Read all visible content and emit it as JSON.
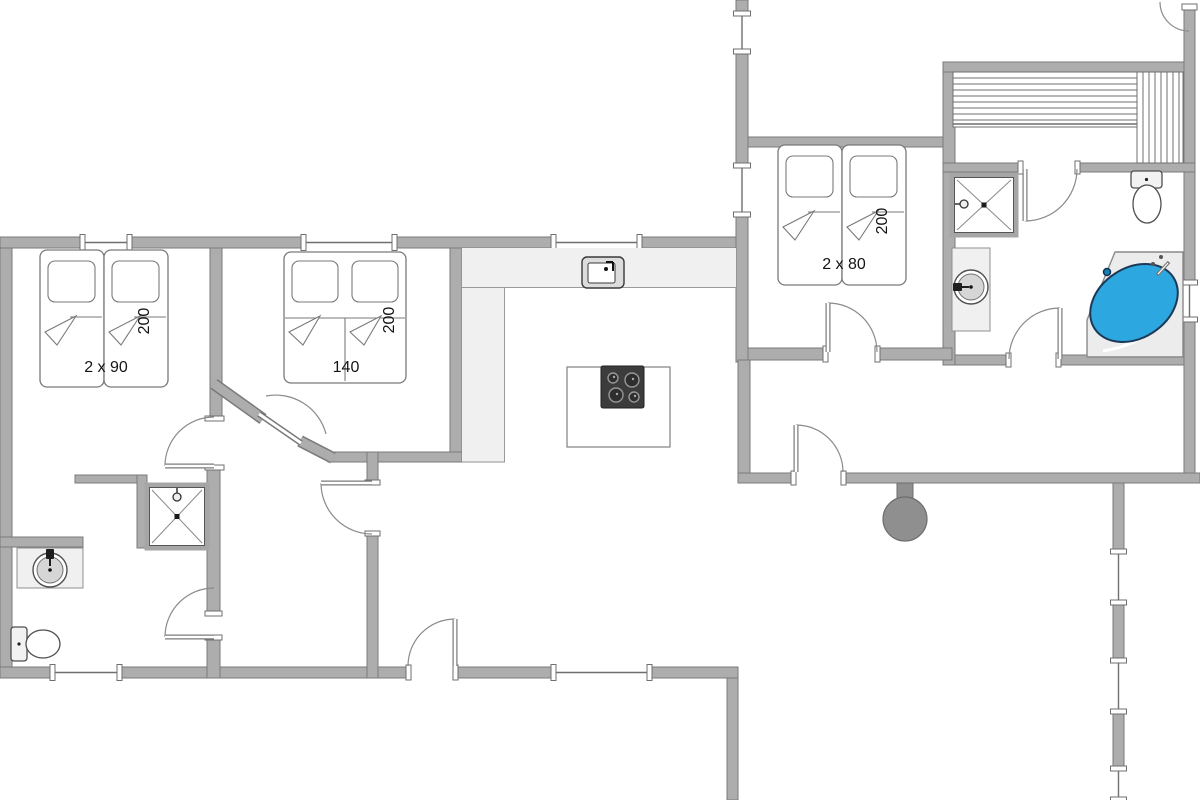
{
  "plan": {
    "width": 1200,
    "height": 800,
    "colors": {
      "wall_fill": "#adadad",
      "wall_edge": "#7a7a7a",
      "line": "#8a8a8a",
      "thin_line": "#6f6f6f",
      "floor": "#ffffff",
      "counter_fill": "#f0f0f0",
      "fixture_light": "#f0f0f0",
      "sink_inner": "#d6d6d6",
      "stove_dark": "#3c3c3c",
      "burner_rim": "#979797",
      "tub_blue": "#2da7e0",
      "tub_edge": "#1c3a57",
      "tub_base": "#ececec",
      "wood_stove": "#8f8f8f",
      "label": "#141414"
    },
    "labels": [
      {
        "text": "2 x 90",
        "x": 106,
        "y": 372,
        "rot": 0
      },
      {
        "text": "200",
        "x": 149,
        "y": 321,
        "rot": -90
      },
      {
        "text": "140",
        "x": 346,
        "y": 372,
        "rot": 0
      },
      {
        "text": "200",
        "x": 394,
        "y": 320,
        "rot": -90
      },
      {
        "text": "2 x 80",
        "x": 844,
        "y": 269,
        "rot": 0
      },
      {
        "text": "200",
        "x": 887,
        "y": 221,
        "rot": -90
      }
    ],
    "walls": [
      [
        0,
        237,
        12,
        441
      ],
      [
        0,
        237,
        746,
        11
      ],
      [
        736,
        0,
        12,
        362
      ],
      [
        748,
        137,
        205,
        10
      ],
      [
        943,
        62,
        12,
        303
      ],
      [
        943,
        62,
        252,
        10
      ],
      [
        1184,
        8,
        11,
        467
      ],
      [
        943,
        163,
        252,
        9
      ],
      [
        955,
        355,
        229,
        10
      ],
      [
        748,
        348,
        204,
        12
      ],
      [
        738,
        360,
        12,
        123
      ],
      [
        738,
        473,
        462,
        10
      ],
      [
        1113,
        483,
        11,
        317
      ],
      [
        727,
        667,
        11,
        133
      ],
      [
        0,
        667,
        738,
        11
      ],
      [
        210,
        248,
        12,
        170
      ],
      [
        450,
        248,
        12,
        214
      ],
      [
        75,
        475,
        72,
        8
      ],
      [
        137,
        475,
        10,
        73
      ],
      [
        207,
        468,
        13,
        145
      ],
      [
        207,
        638,
        13,
        40
      ],
      [
        0,
        537,
        83,
        10
      ],
      [
        328,
        452,
        134,
        10
      ],
      [
        367,
        452,
        11,
        226
      ]
    ],
    "diag_walls": [
      [
        214,
        384,
        263,
        419
      ],
      [
        300,
        441,
        333,
        458
      ]
    ],
    "caps_extra": [
      [
        1182,
        4,
        15,
        6
      ]
    ],
    "openings": [
      {
        "x": 207,
        "y": 418,
        "w": 15,
        "h": 50,
        "dir": "v"
      },
      {
        "x": 367,
        "y": 482,
        "w": 11,
        "h": 52,
        "dir": "v"
      },
      {
        "x": 207,
        "y": 613,
        "w": 13,
        "h": 25,
        "dir": "v"
      },
      {
        "x": 408,
        "y": 667,
        "w": 48,
        "h": 11,
        "dir": "h"
      },
      {
        "x": 793,
        "y": 473,
        "w": 51,
        "h": 10,
        "dir": "h"
      },
      {
        "x": 825,
        "y": 348,
        "w": 53,
        "h": 12,
        "dir": "h"
      },
      {
        "x": 1020,
        "y": 163,
        "w": 58,
        "h": 9,
        "dir": "h"
      },
      {
        "x": 1008,
        "y": 355,
        "w": 51,
        "h": 10,
        "dir": "h"
      }
    ],
    "windows": [
      {
        "dir": "h",
        "x": 82,
        "y": 237,
        "len": 48,
        "t": 11
      },
      {
        "dir": "h",
        "x": 303,
        "y": 237,
        "len": 92,
        "t": 11
      },
      {
        "dir": "h",
        "x": 553,
        "y": 237,
        "len": 87,
        "t": 11
      },
      {
        "dir": "h",
        "x": 52,
        "y": 667,
        "len": 68,
        "t": 11
      },
      {
        "dir": "h",
        "x": 553,
        "y": 667,
        "len": 97,
        "t": 11
      },
      {
        "dir": "v",
        "x": 736,
        "y": 13,
        "len": 39,
        "t": 12
      },
      {
        "dir": "v",
        "x": 736,
        "y": 165,
        "len": 50,
        "t": 12
      },
      {
        "dir": "v",
        "x": 1184,
        "y": 282,
        "len": 38,
        "t": 11
      },
      {
        "dir": "v",
        "x": 1113,
        "y": 551,
        "len": 52,
        "t": 11
      },
      {
        "dir": "v",
        "x": 1113,
        "y": 660,
        "len": 52,
        "t": 11
      },
      {
        "dir": "v",
        "x": 1113,
        "y": 768,
        "len": 32,
        "t": 11
      }
    ],
    "doors": [
      {
        "hx": 214,
        "hy": 466,
        "r": 49,
        "a0": 180,
        "leaf": 180
      },
      {
        "hx": 372,
        "hy": 483,
        "r": 51,
        "a0": 90,
        "leaf": 180
      },
      {
        "hx": 214,
        "hy": 637,
        "r": 49,
        "a0": 180,
        "leaf": 180
      },
      {
        "hx": 455,
        "hy": 666,
        "r": 47,
        "a0": 180,
        "leaf": 270
      },
      {
        "hx": 796,
        "hy": 472,
        "r": 47,
        "a0": 270,
        "leaf": 270
      },
      {
        "hx": 828,
        "hy": 352,
        "r": 49,
        "a0": 270,
        "leaf": 270
      },
      {
        "hx": 1025,
        "hy": 169,
        "r": 52,
        "a0": 0,
        "leaf": 90
      },
      {
        "hx": 1060,
        "hy": 359,
        "r": 51,
        "a0": 180,
        "leaf": 270
      },
      {
        "hx": 1189,
        "hy": 2,
        "r": 29,
        "a0": 90,
        "leaf": null
      }
    ],
    "angled_door": {
      "arc": "M 266 396 A 52 52 0 0 1 326 434",
      "leaf": [
        259,
        414,
        301,
        443
      ]
    },
    "beds": {
      "singles": [
        [
          40,
          250,
          64,
          137
        ],
        [
          104,
          250,
          64,
          137
        ],
        [
          778,
          145,
          64,
          140
        ],
        [
          842,
          145,
          64,
          140
        ]
      ],
      "doubles": [
        [
          284,
          252,
          122,
          131
        ]
      ]
    },
    "showers": [
      {
        "x": 952,
        "y": 175,
        "w": 64,
        "h": 60,
        "head": "left"
      },
      {
        "x": 147,
        "y": 485,
        "w": 60,
        "h": 63,
        "head": "top"
      }
    ],
    "vanity_sinks": [
      {
        "rx": 952,
        "ry": 248,
        "rw": 38,
        "rh": 83,
        "cx": 971,
        "cy": 287,
        "r": 17,
        "faucet": "left"
      },
      {
        "rx": 17,
        "ry": 548,
        "rw": 66,
        "rh": 40,
        "cx": 50,
        "cy": 570,
        "r": 17,
        "faucet": "top"
      }
    ],
    "toilets": [
      {
        "tank": [
          1131,
          171,
          31,
          17
        ],
        "cx": 1147,
        "cy": 204,
        "ex": 14,
        "ey": 19
      },
      {
        "tank": [
          11,
          627,
          16,
          34
        ],
        "cx": 43,
        "cy": 644,
        "ex": 17,
        "ey": 14
      }
    ],
    "tub": {
      "outline": "1115,252 1183,252 1183,357 1087,357 1087,320",
      "curve": "M 1103 351 Q 1160 342 1176 295",
      "cx": 1134,
      "cy": 303,
      "ex": 47,
      "ey": 35,
      "rot": -33,
      "drain": [
        1107,
        272
      ],
      "faucet": [
        1157,
        275,
        1169,
        262
      ],
      "dots": [
        [
          1153,
          264
        ],
        [
          1161,
          257
        ]
      ]
    },
    "sauna": {
      "h_area": [
        953,
        72,
        184,
        55
      ],
      "v_area": [
        1137,
        72,
        46,
        91
      ],
      "gap": 6
    },
    "kitchen": {
      "counter_top": [
        462,
        248,
        274,
        40
      ],
      "counter_left": [
        462,
        288,
        43,
        175
      ],
      "edges": [
        [
          462,
          287.5,
          736,
          287.5
        ],
        [
          504.5,
          288,
          504.5,
          462
        ],
        [
          462,
          462,
          505,
          462
        ]
      ],
      "island": [
        567,
        367,
        103,
        80
      ],
      "stove": [
        601,
        366,
        43,
        42
      ],
      "burners": [
        [
          613,
          378,
          5
        ],
        [
          632,
          380,
          7
        ],
        [
          616,
          395,
          7
        ],
        [
          634,
          397,
          5
        ]
      ],
      "sink_outer": [
        582,
        257,
        42,
        31
      ],
      "sink_inner": [
        588,
        263,
        27,
        20
      ]
    },
    "wood_stove": {
      "stem": [
        897,
        483,
        16,
        28
      ],
      "cx": 905,
      "cy": 519,
      "r": 22
    }
  }
}
